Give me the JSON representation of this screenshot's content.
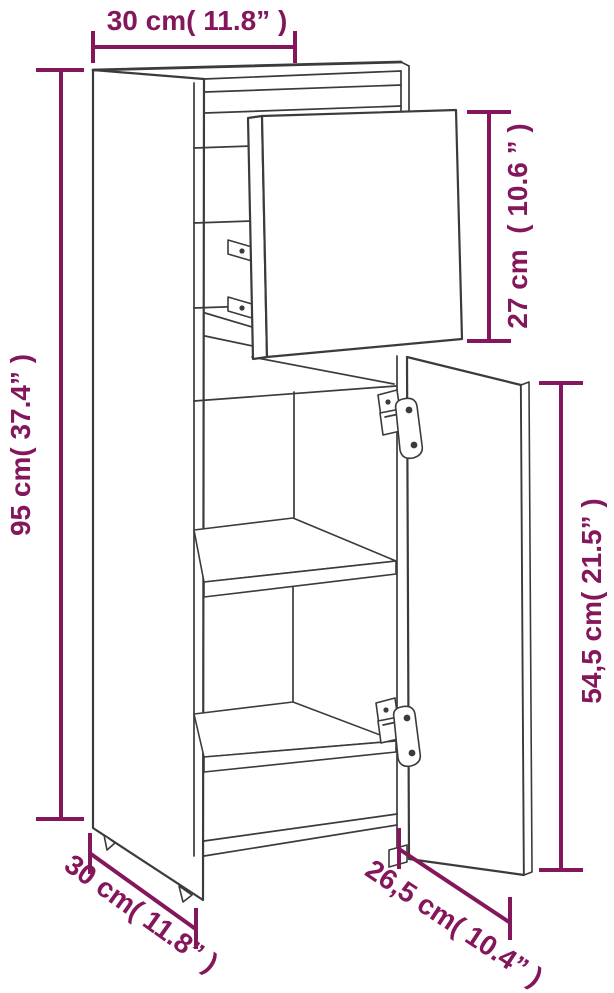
{
  "page": {
    "background": "#ffffff",
    "width_px": 614,
    "height_px": 993
  },
  "diagram": {
    "title": "Cabinet dimension diagram",
    "subject": "Tall narrow cabinet line drawing with detached upper door, open lower door, interior shelves and concealed hinges",
    "accent_color": "#84175C",
    "line_color": "#3B3B3B",
    "dimensions": {
      "width_top": {
        "label": "30 cm( 11.8” )",
        "cm": "30",
        "inches": "11.8"
      },
      "upper_door_height": {
        "label": "27 cm  ( 10.6 ” )",
        "cm": "27",
        "inches": "10.6"
      },
      "height_total": {
        "label": "95 cm( 37.4” )",
        "cm": "95",
        "inches": "37.4"
      },
      "lower_door_height": {
        "label": "54,5 cm( 21.5” )",
        "cm": "54,5",
        "inches": "21.5"
      },
      "depth_bottom": {
        "label": "30 cm( 11.8” )",
        "cm": "30",
        "inches": "11.8"
      },
      "lower_door_width": {
        "label": "26,5 cm( 10.4” )",
        "cm": "26,5",
        "inches": "10.4"
      }
    }
  }
}
